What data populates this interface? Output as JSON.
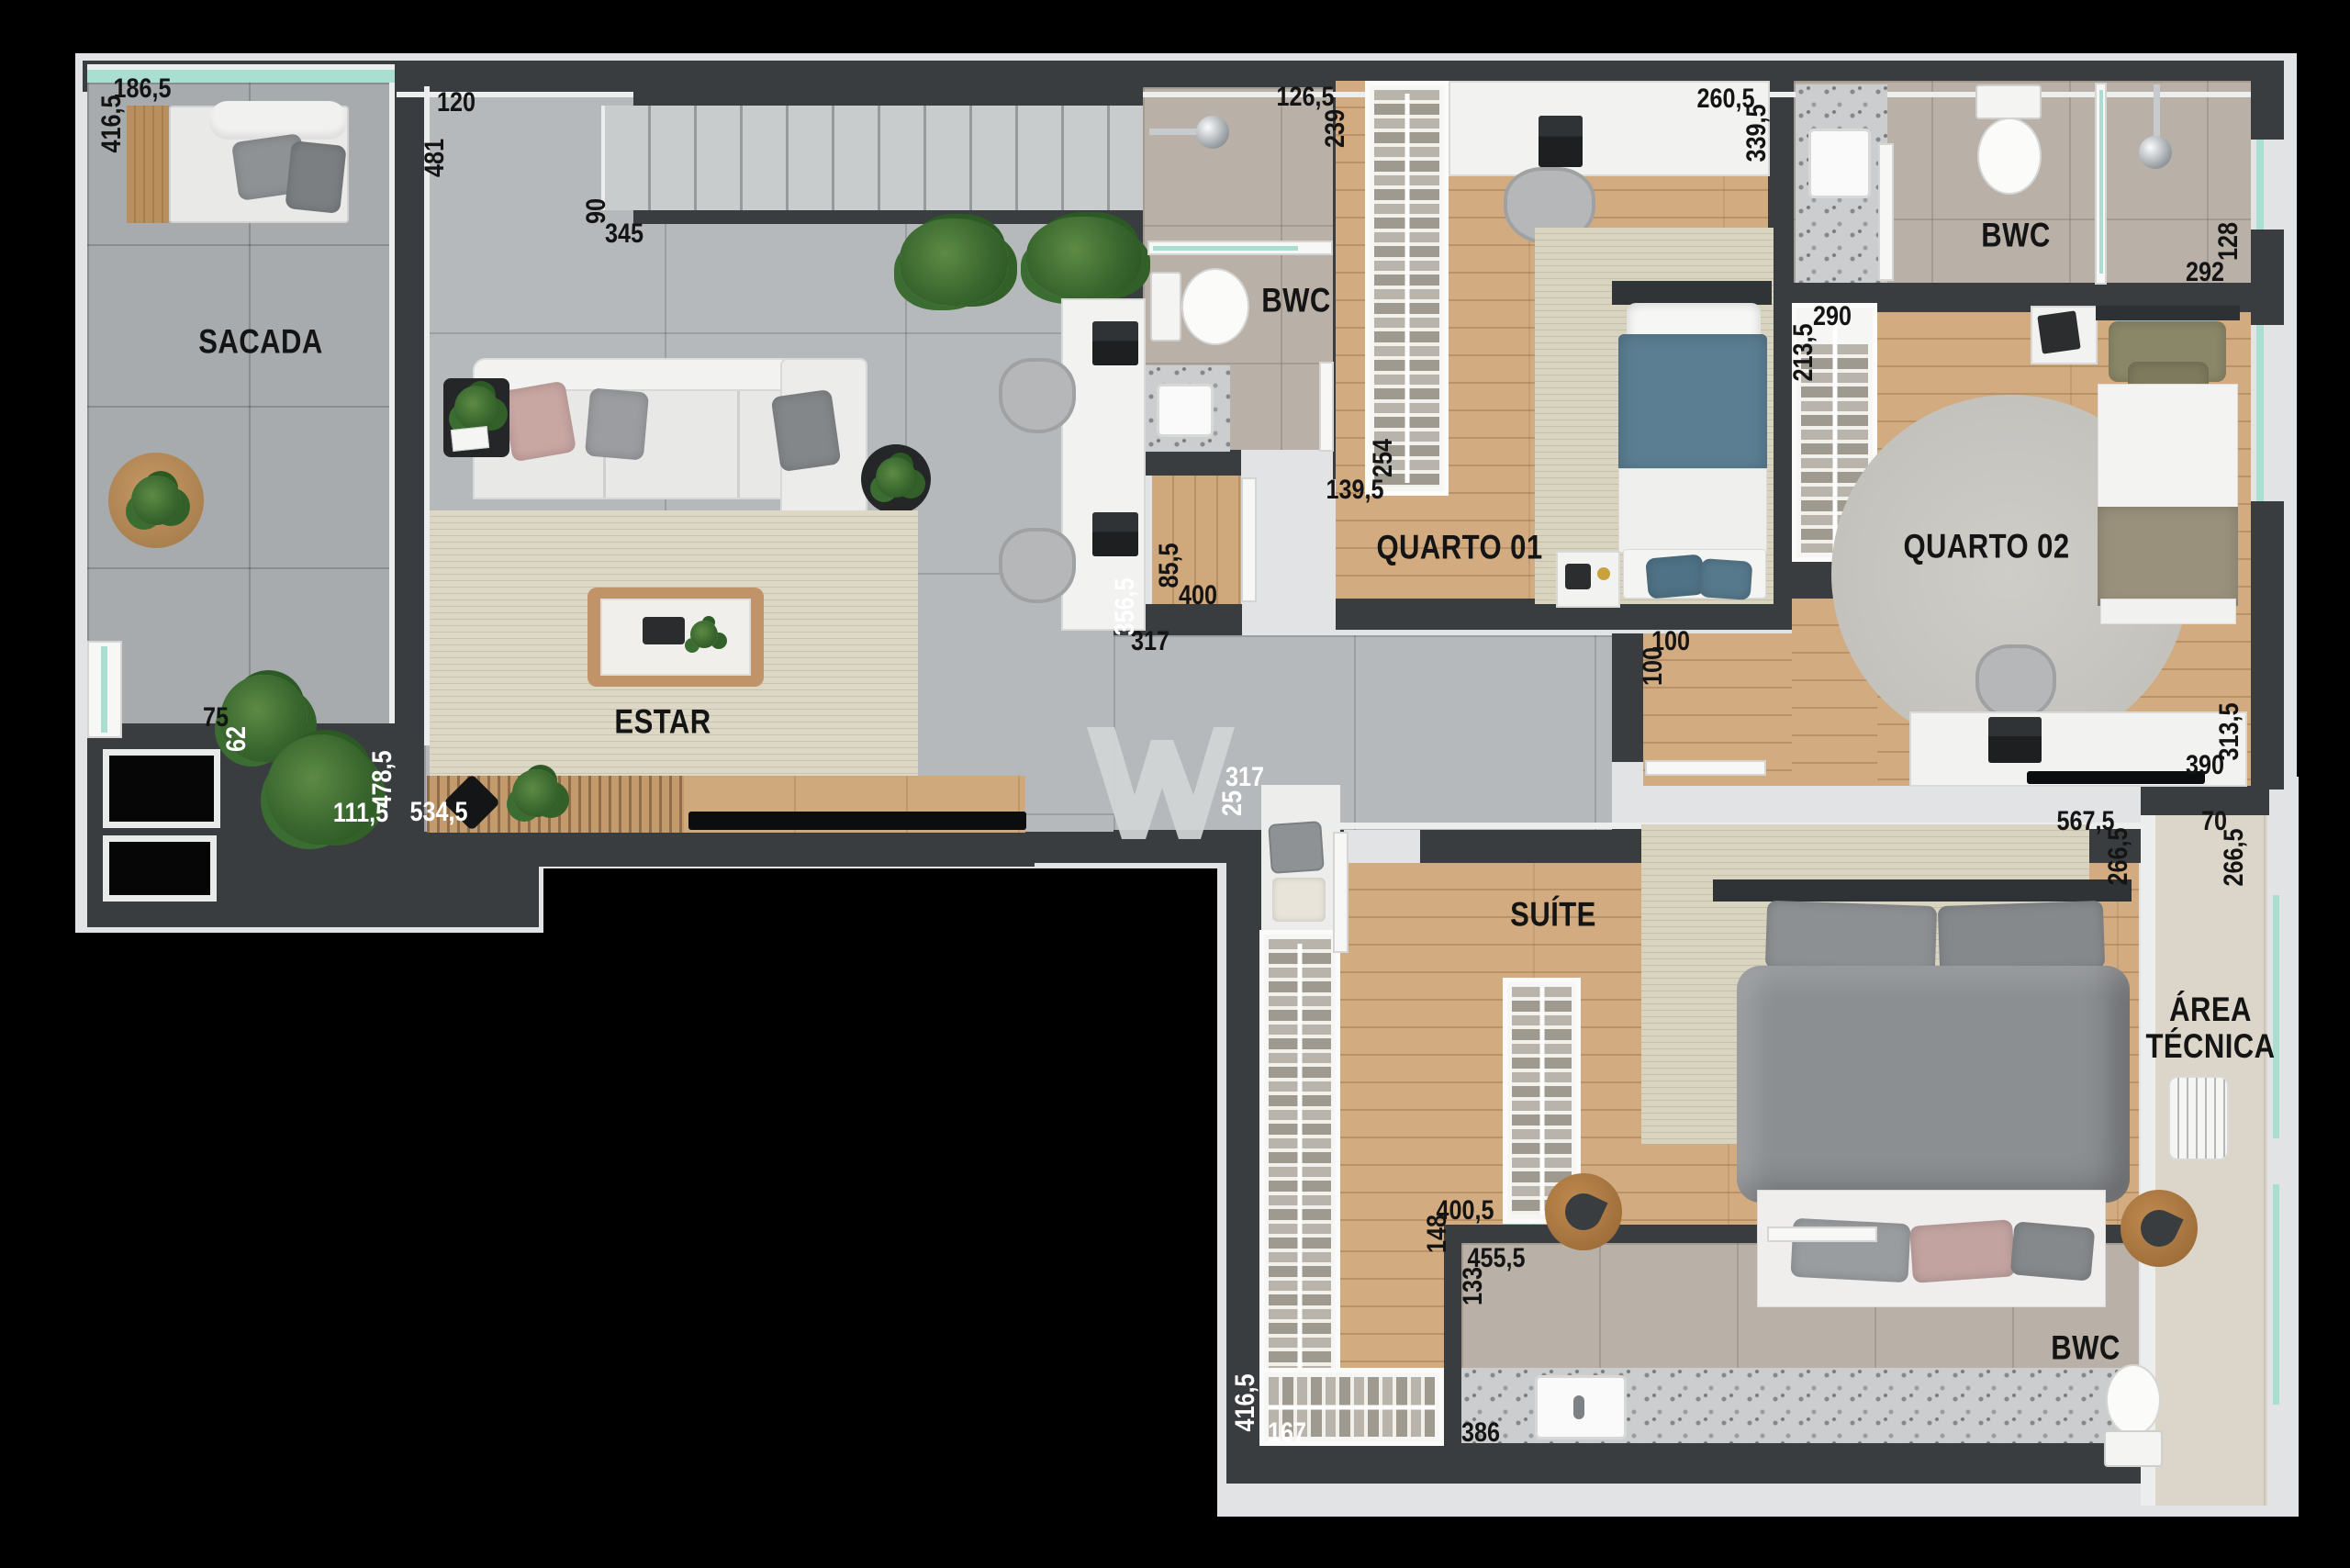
{
  "plan_type": "floor plan - apartment top view render",
  "rooms": {
    "sacada": "SACADA",
    "estar": "ESTAR",
    "bwc1": "BWC",
    "quarto01": "QUARTO 01",
    "bwc2": "BWC",
    "quarto02": "QUARTO 02",
    "suite": "SUÍTE",
    "area_tecnica": "ÁREA TÉCNICA",
    "bwc3": "BWC"
  },
  "dims": {
    "sacada_top": "186,5",
    "sacada_left": "416,5",
    "estar_top": "120",
    "estar_left": "481",
    "stairs_h": "90",
    "stairs_w": "345",
    "bwc1_top": "126,5",
    "bwc1_side": "239",
    "bwc1_door": "139,5",
    "closet_q1": "254",
    "desk_q1_w": "260,5",
    "desk_q1_h": "339,5",
    "niche_h": "85,5",
    "niche_w": "400",
    "estar_opening": "317",
    "estar_wall_r": "356,5",
    "hall_opening_w": "100",
    "hall_opening_h": "100",
    "closet_q2_w": "290",
    "closet_q2_h": "213,5",
    "bwc2_w": "292",
    "bwc2_h": "128",
    "desk_q2_w": "390",
    "desk_q2_h": "313,5",
    "sacada_b1": "75",
    "sacada_b2": "62",
    "sacada_b3": "478,5",
    "sacada_b4": "111,5",
    "estar_tv_wall": "534,5",
    "suite_entry_w": "317",
    "suite_entry_t": "25",
    "suite_top_w": "567,5",
    "suite_top_h": "266,5",
    "at_w": "70",
    "at_h": "266,5",
    "suite_closet_top_w": "400,5",
    "suite_closet_top_h": "148",
    "bwc3_w": "455,5",
    "bwc3_h": "133",
    "bwc3_counter": "386",
    "suite_closet_left_h": "416,5",
    "suite_closet_left_w": "167"
  },
  "palette": {
    "wall": "#3a3d40",
    "trim": "#eceded",
    "glass": "#a9dfd0",
    "tile_gray": "#a7abad",
    "tile_light": "#b6b9bb",
    "wood": "#d2ab80",
    "bath_tile": "#b9b1a8",
    "label_dark": "#141414",
    "label_light": "#ffffff"
  },
  "watermark": "W logo"
}
